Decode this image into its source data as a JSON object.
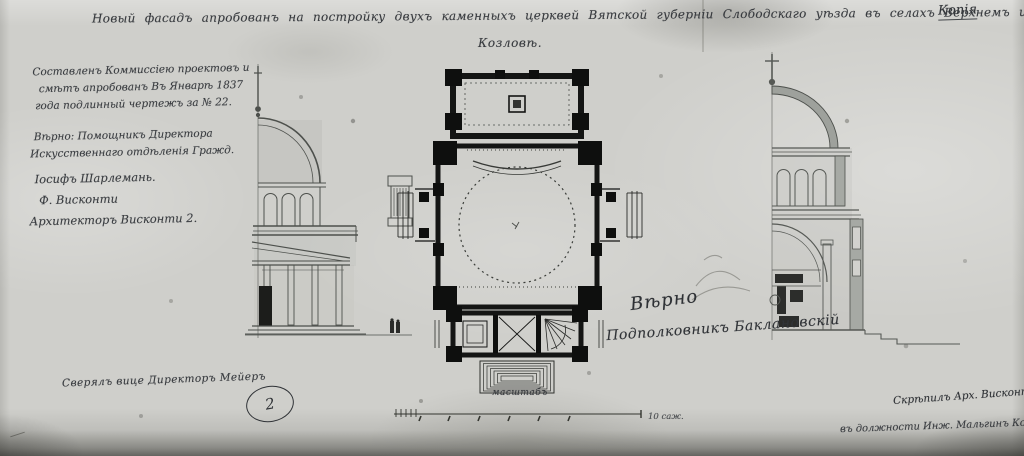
{
  "sheet": {
    "copy_label": "Копія",
    "paper_color": "#cfcfcb",
    "ink_color": "#383b3f",
    "poche_color": "#111111"
  },
  "title": {
    "line1": "Новый фасадъ апробованъ на постройку двухъ каменныхъ церквей Вятской губерніи Слободскаго уѣзда въ селахъ Верхнемъ и Старомъ",
    "line2": "Козловѣ."
  },
  "left_annotation": {
    "lines": [
      "Составленъ Коммиссіею проектовъ и",
      "смѣтъ апробованъ Въ Январѣ 1837",
      "года подлинный чертежъ за № 22.",
      "Вѣрно: Помощникъ Директора",
      "Искусственнаго отдѣленія Гражд.",
      "Іосифъ Шарлемань.",
      "Ф. Висконти",
      "Архитекторъ Висконти 2."
    ]
  },
  "center_signature": {
    "line1": "Вѣрно",
    "line2": "Подполковникъ Баклановскій"
  },
  "scale": {
    "caption": "масштабъ",
    "unit_label": "10 саж."
  },
  "bottom_left": {
    "note": "Сверялъ вице Директоръ Мейеръ",
    "register_number": "2"
  },
  "bottom_right": {
    "line1": "Скрѣпилъ Арх. Висконти",
    "line2": "въ должности Инж. Мальгинъ Ко."
  }
}
